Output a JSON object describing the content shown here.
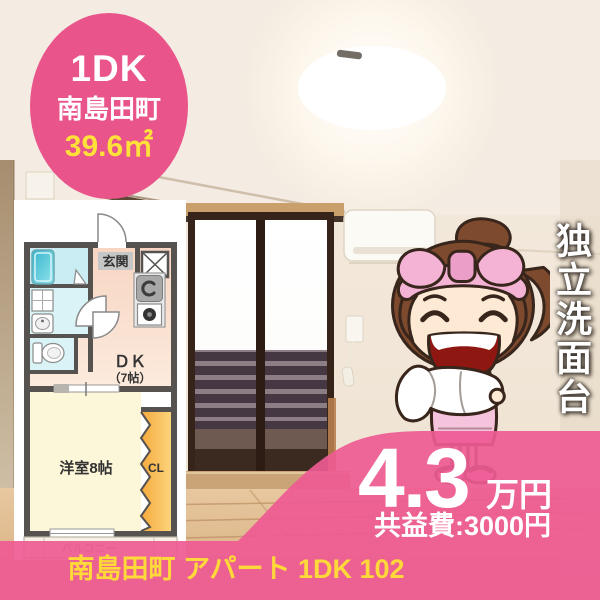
{
  "listing": {
    "badge": {
      "layout": "1DK",
      "town": "南島田町",
      "area": "39.6㎡"
    },
    "feature_vertical": "独立洗面台",
    "price": {
      "amount": "4.3",
      "unit": "万円",
      "common_fee": "共益費:3000円"
    },
    "title": "南島田町 アパート 1DK 102"
  },
  "floorplan": {
    "entrance": "玄関",
    "dk": "ＤＫ",
    "dk_size": "（7帖）",
    "western_room": "洋室8帖",
    "closet": "CL",
    "balcony": "バルコニー"
  },
  "colors": {
    "accent_pink": "#ee5a93",
    "badge_pink": "#e9548b",
    "highlight_yellow": "#ffdf3c",
    "price_text_white": "#ffffff",
    "plan_wall_gray": "#55524f",
    "plan_bath_cyan": "#cdeef3",
    "plan_tub_cyan": "#3ab8cd",
    "plan_room_yellow": "#fdf7d9",
    "plan_dk_peach": "#f9ddcc",
    "plan_closet_orange": "#f6a93c"
  }
}
